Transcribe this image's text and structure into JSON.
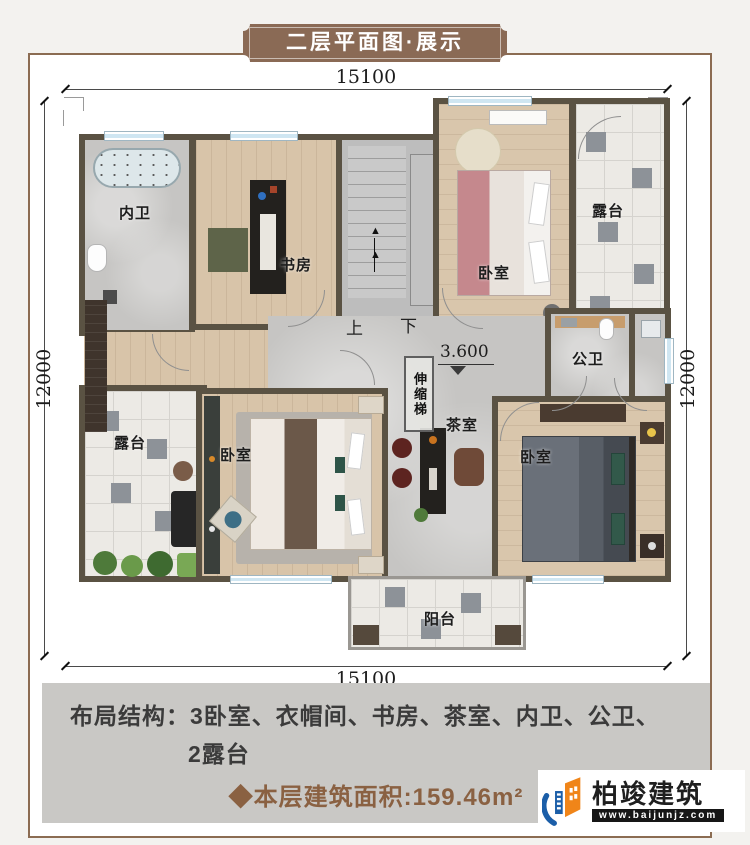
{
  "banner": {
    "title": "二层平面图·展示"
  },
  "dims": {
    "top": "15100",
    "bottom": "15100",
    "left": "12000",
    "right": "12000"
  },
  "plan": {
    "rooms": [
      {
        "id": "bath-inner",
        "label": "内卫"
      },
      {
        "id": "study",
        "label": "书房"
      },
      {
        "id": "bedroom-tr",
        "label": "卧室"
      },
      {
        "id": "terrace-r",
        "label": "露台"
      },
      {
        "id": "bath-public",
        "label": "公卫"
      },
      {
        "id": "terrace-l",
        "label": "露台"
      },
      {
        "id": "bedroom-bl",
        "label": "卧室"
      },
      {
        "id": "tea-room",
        "label": "茶室"
      },
      {
        "id": "bedroom-br",
        "label": "卧室"
      },
      {
        "id": "balcony",
        "label": "阳台"
      }
    ],
    "stairs": {
      "up": "上",
      "down": "下",
      "arrow": "▲"
    },
    "elevation": "3.600",
    "ladder": "伸缩梯"
  },
  "footer": {
    "layout_label": "布局结构：",
    "layout_items_line1": "3卧室、衣帽间、书房、茶室、内卫、公卫、",
    "layout_items_line2": "2露台",
    "area_text": "◆本层建筑面积:159.46m²"
  },
  "logo": {
    "name": "柏竣建筑",
    "url": "www.baijunjz.com"
  },
  "colors": {
    "banner_brown": "#8a6a55",
    "frame_brown": "#8b6c52",
    "wall": "#5a5243",
    "area_text_brown": "#8a6142",
    "logo_blue": "#1b5ea8",
    "logo_orange": "#f08519",
    "footer_gray": "#c9c8c5"
  }
}
